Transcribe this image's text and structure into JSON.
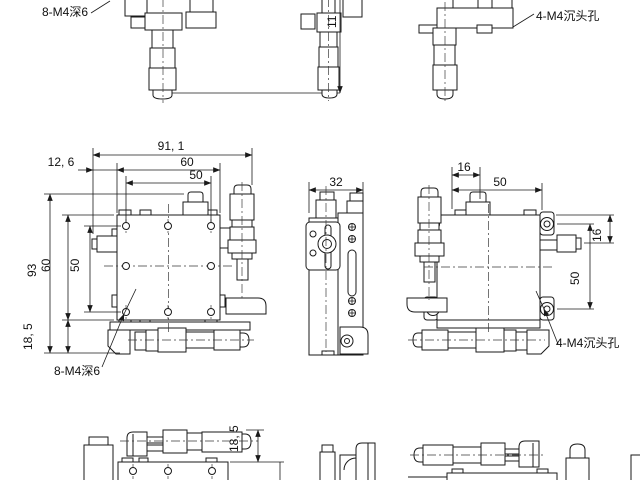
{
  "colors": {
    "background": "#ffffff",
    "line": "#1a1a1a",
    "dimension": "#1a1a1a"
  },
  "labels": {
    "thread_note_top": "8-M4深6",
    "countersink_note_top": "4-M4沉头孔",
    "thread_note_front": "8-M4深6",
    "countersink_note_back": "4-M4沉头孔"
  },
  "dimensions": {
    "top_view_height": "11",
    "front_total_width": "91, 1",
    "front_left_offset": "12, 6",
    "front_top_width_outer": "60",
    "front_top_width_inner": "50",
    "front_overall_height": "93",
    "front_side_height_outer": "60",
    "front_side_height_inner": "50",
    "front_bottom_height": "18, 5",
    "side_width": "32",
    "back_top_offset": "16",
    "back_top_width": "50",
    "back_right_offset": "16",
    "back_right_height": "50",
    "bottom_view_height": "18, 5"
  }
}
